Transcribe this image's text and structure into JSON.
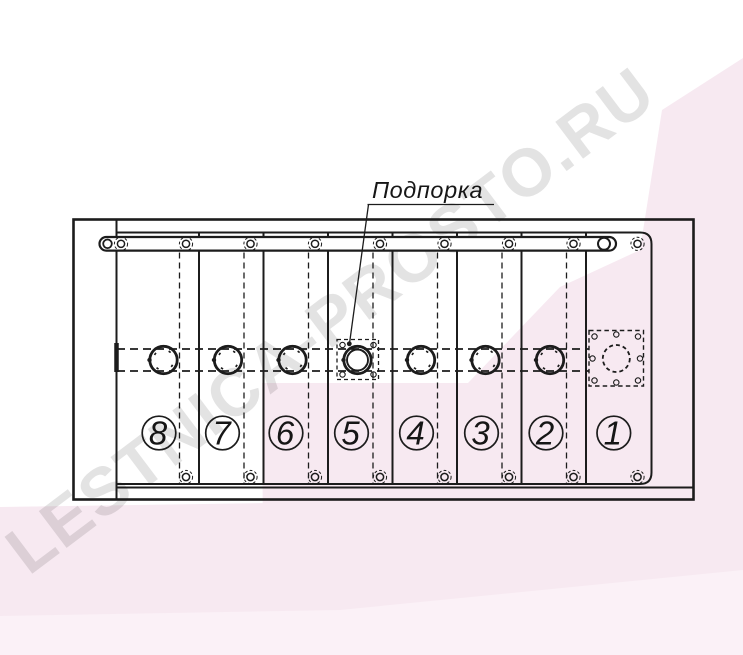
{
  "watermark": {
    "text": "LESTNICA-PROSTO.RU",
    "text_color": "#e3e3e3",
    "band_color": "#f7e9f1",
    "band_color_light": "#fbf1f7"
  },
  "annotation": {
    "label": "Подпорка"
  },
  "drawing": {
    "type": "technical-assembly-drawing",
    "line_color": "#1c1c1c",
    "panel_count": 8,
    "panel_numbers": [
      "8",
      "7",
      "6",
      "5",
      "4",
      "3",
      "2",
      "1"
    ]
  }
}
